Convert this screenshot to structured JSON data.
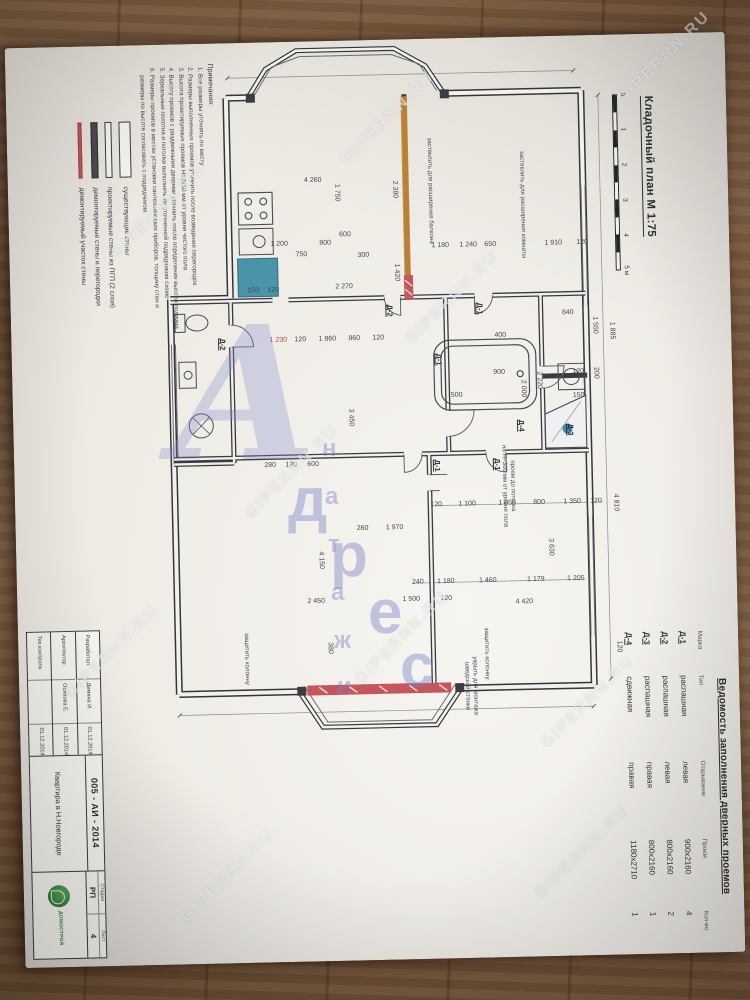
{
  "photo": {
    "watermark_text": "GIPERNN.RU",
    "watermarks": [
      [
        388,
        118
      ],
      [
        158,
        212
      ],
      [
        452,
        298
      ],
      [
        292,
        472
      ],
      [
        112,
        652
      ],
      [
        402,
        638
      ],
      [
        588,
        702
      ],
      [
        228,
        876
      ],
      [
        582,
        852
      ],
      [
        664,
        58
      ]
    ],
    "logo": {
      "big_letter": "А",
      "letters": [
        {
          "ch": "д",
          "x": 118,
          "y": 150,
          "s": 62
        },
        {
          "ch": "р",
          "x": 160,
          "y": 205,
          "s": 62
        },
        {
          "ch": "е",
          "x": 198,
          "y": 262,
          "s": 62
        },
        {
          "ch": "с",
          "x": 230,
          "y": 316,
          "s": 62
        },
        {
          "ch": "н",
          "x": 152,
          "y": 120,
          "s": 24
        },
        {
          "ch": "а",
          "x": 155,
          "y": 168,
          "s": 24
        },
        {
          "ch": "т",
          "x": 158,
          "y": 216,
          "s": 24
        },
        {
          "ch": "а",
          "x": 161,
          "y": 264,
          "s": 24
        },
        {
          "ch": "ж",
          "x": 164,
          "y": 312,
          "s": 24
        },
        {
          "ch": "и",
          "x": 167,
          "y": 358,
          "s": 24
        }
      ]
    }
  },
  "document": {
    "title": "Кладочный план М 1:75",
    "scale_bar": {
      "ticks": [
        "0",
        "1",
        "2",
        "3",
        "4"
      ],
      "end_label": "5 м"
    },
    "door_schedule": {
      "title": "Ведомость заполнения дверных проемов",
      "columns": [
        "Марка",
        "Тип",
        "Открывание",
        "Проем",
        "Кол-во"
      ],
      "rows": [
        {
          "mark": "Д-1",
          "type": "распашная",
          "opening": "левая",
          "size": "900х2160",
          "qty": "4"
        },
        {
          "mark": "Д-2",
          "type": "распашная",
          "opening": "левая",
          "size": "800х2160",
          "qty": "2"
        },
        {
          "mark": "Д-3",
          "type": "распашная",
          "opening": "правая",
          "size": "800х2160",
          "qty": "1"
        },
        {
          "mark": "Д-4",
          "type": "сдвижная",
          "opening": "правая",
          "size": "1180х2710",
          "qty": "1"
        }
      ]
    },
    "legend": {
      "items": [
        {
          "style": "sw-exist",
          "label": "существующие стены"
        },
        {
          "style": "sw-pgp",
          "label": "проектируемые стены из ПГП (2 слоя)"
        },
        {
          "style": "sw-demo",
          "label": "демонтируемые стены и перегородки"
        },
        {
          "style": "sw-red",
          "label": "демонтируемый участок стены"
        }
      ]
    },
    "notes": {
      "heading": "Примечания:",
      "items": [
        "Все размеры уточнять по месту",
        "Размеры выполненных проемов уточнить после возведения перегородок",
        "Высота проектируемых проемов Н=2160 мм от уровня чистого пола",
        "Высоту проемов с раздвижными дверями уточнить после определения высоты подиума",
        "Зеркальные полотна и потолки выполнять по уточненной подрядчиком схеме",
        "Размеры проемов в местах установки сантехнических приборов, толщину стен и размеры по высоте согласовать с подрядчиком"
      ]
    },
    "title_block": {
      "code": "005 - АИ - 2014",
      "project": "Квартира в Н.Новгороде",
      "stage_label": "Стадия",
      "stage": "РП",
      "sheet_label": "Лист",
      "sheet": "4",
      "rows": [
        {
          "role": "Разработал",
          "name": "Демина И.",
          "date": "01.12.2014"
        },
        {
          "role": "Архитектор",
          "name": "Осипова Е.",
          "date": "01.12.2014"
        },
        {
          "role": "Тех.контроль",
          "name": "",
          "date": "01.12.2014"
        }
      ],
      "logo_caption": "ДОМОСТРОЙ"
    },
    "plan": {
      "labels": [
        [
          "4 260",
          140,
          415,
          "v",
          "dim"
        ],
        [
          "1 200",
          203,
          450,
          "v",
          "dim"
        ],
        [
          "750",
          214,
          428,
          "v",
          "dim"
        ],
        [
          "800",
          203,
          404,
          "v",
          "dim"
        ],
        [
          "600",
          195,
          384,
          "v",
          "dim"
        ],
        [
          "300",
          216,
          366,
          "v",
          "dim"
        ],
        [
          "1 750",
          152,
          392,
          "h",
          "dim"
        ],
        [
          "150",
          249,
          477,
          "v",
          "dim"
        ],
        [
          "120",
          249,
          457,
          "v",
          "dim"
        ],
        [
          "2 380",
          150,
          334,
          "h",
          "dim"
        ],
        [
          "1 420",
          233,
          334,
          "h",
          "dim"
        ],
        [
          "1 230",
          299,
          453,
          "v",
          "red"
        ],
        [
          "120",
          299,
          431,
          "v",
          "dim"
        ],
        [
          "1 860",
          299,
          404,
          "v",
          "dim"
        ],
        [
          "860",
          299,
          377,
          "v",
          "dim"
        ],
        [
          "120",
          299,
          353,
          "v",
          "dim"
        ],
        [
          "2 270",
          247,
          386,
          "v",
          "dim"
        ],
        [
          "застеклить для расширения балкона",
          152,
          298,
          "h",
          "note"
        ],
        [
          "застеклить для расширения комнаты",
          168,
          206,
          "h",
          "note"
        ],
        [
          "1 885",
          296,
          120,
          "h",
          "dim"
        ],
        [
          "4 810",
          468,
          120,
          "h",
          "dim"
        ],
        [
          "120",
          612,
          120,
          "h",
          "dim"
        ],
        [
          "1 550",
          290,
          137,
          "h",
          "dim"
        ],
        [
          "200",
          338,
          137,
          "h",
          "dim"
        ],
        [
          "2 220",
          344,
          194,
          "h",
          "dim"
        ],
        [
          "2 000",
          352,
          210,
          "h",
          "dim"
        ],
        [
          "900",
          336,
          233,
          "v",
          "dim"
        ],
        [
          "500",
          358,
          276,
          "v",
          "dim"
        ],
        [
          "150",
          361,
          154,
          "v",
          "dim"
        ],
        [
          "120",
          337,
          154,
          "v",
          "dim"
        ],
        [
          "Д-3",
          394,
          163,
          "h",
          "mark"
        ],
        [
          "Д-4",
          389,
          212,
          "h",
          "mark"
        ],
        [
          "Д-1",
          271,
          251,
          "h",
          "mark"
        ],
        [
          "Д-2",
          271,
          341,
          "h",
          "mark"
        ],
        [
          "Д-1",
          321,
          293,
          "h",
          "mark"
        ],
        [
          "Д-1",
          427,
          297,
          "h",
          "mark"
        ],
        [
          "Д-1",
          427,
          237,
          "h",
          "mark"
        ],
        [
          "Д-2",
          301,
          509,
          "h",
          "mark"
        ],
        [
          "проем до потолка\nна Н=300 мм от уровня пола",
          449,
          226,
          "h",
          "note"
        ],
        [
          "120",
          467,
          299,
          "v",
          "dim"
        ],
        [
          "1 100",
          467,
          268,
          "v",
          "dim"
        ],
        [
          "1 050",
          467,
          228,
          "v",
          "dim"
        ],
        [
          "800",
          467,
          196,
          "v",
          "dim"
        ],
        [
          "1 350",
          467,
          163,
          "v",
          "dim"
        ],
        [
          "120",
          467,
          139,
          "v",
          "dim"
        ],
        [
          "240",
          544,
          319,
          "v",
          "dim"
        ],
        [
          "1 180",
          544,
          291,
          "v",
          "dim"
        ],
        [
          "1 460",
          544,
          249,
          "v",
          "dim"
        ],
        [
          "1 179",
          544,
          201,
          "v",
          "dim"
        ],
        [
          "1 205",
          544,
          161,
          "v",
          "dim"
        ],
        [
          "4 420",
          566,
          213,
          "v",
          "dim"
        ],
        [
          "2 450",
          561,
          421,
          "v",
          "dim"
        ],
        [
          "1 500",
          561,
          326,
          "v",
          "dim"
        ],
        [
          "120",
          561,
          291,
          "v",
          "dim"
        ],
        [
          "380",
          607,
          409,
          "h",
          "dim"
        ],
        [
          "3 450",
          377,
          383,
          "h",
          "dim"
        ],
        [
          "4 150",
          519,
          416,
          "h",
          "dim"
        ],
        [
          "3 630",
          511,
          186,
          "h",
          "dim"
        ],
        [
          "1 970",
          489,
          341,
          "v",
          "dim"
        ],
        [
          "260",
          489,
          373,
          "v",
          "dim"
        ],
        [
          "280",
          424,
          464,
          "v",
          "dim"
        ],
        [
          "120",
          424,
          443,
          "v",
          "dim"
        ],
        [
          "600",
          424,
          421,
          "v",
          "dim"
        ],
        [
          "защитить колонну",
          616,
          252,
          "h",
          "note"
        ],
        [
          "укрыть для монтажа\nшведской стенки",
          648,
          268,
          "h",
          "note"
        ],
        [
          "защитить колонну",
          616,
          492,
          "h",
          "note"
        ],
        [
          "840",
          278,
          163,
          "v",
          "dim"
        ],
        [
          "400",
          299,
          231,
          "v",
          "dim"
        ],
        [
          "1 180",
          208,
          289,
          "v",
          "dim"
        ],
        [
          "1 240",
          208,
          261,
          "v",
          "dim"
        ],
        [
          "650",
          208,
          239,
          "v",
          "dim"
        ],
        [
          "1 910",
          208,
          176,
          "v",
          "dim"
        ],
        [
          "120",
          208,
          147,
          "v",
          "dim"
        ]
      ]
    }
  }
}
